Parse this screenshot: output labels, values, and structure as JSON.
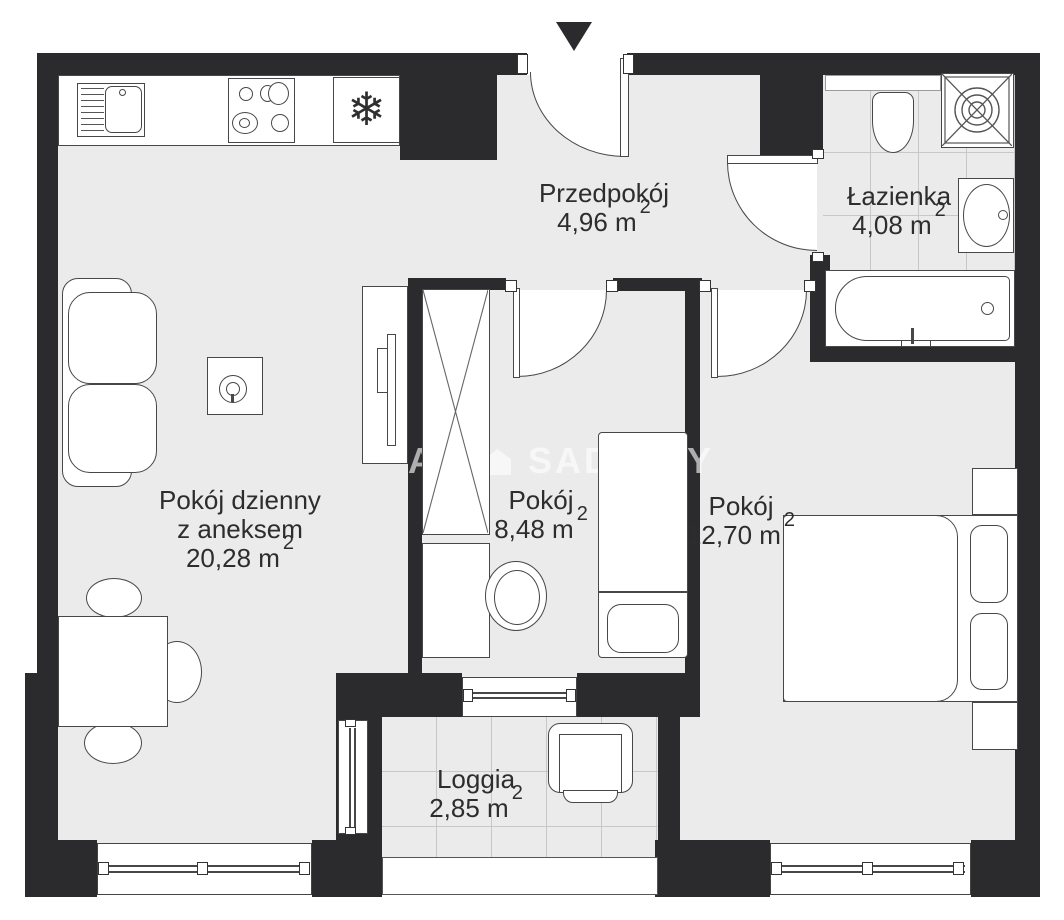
{
  "watermark": {
    "part1": "A",
    "icon": "house-icon",
    "part2": "SADU",
    "part3": "Y"
  },
  "rooms": {
    "hall": {
      "name": "Przedpokój",
      "area": "4,96 m",
      "sup": "2"
    },
    "bath": {
      "name": "Łazienka",
      "area": "4,08 m",
      "sup": "2"
    },
    "living": {
      "name_line1": "Pokój dzienny",
      "name_line2": "z aneksem",
      "area": "20,28 m",
      "sup": "2"
    },
    "room_small": {
      "name": "Pokój",
      "area": "8,48 m",
      "sup": "2"
    },
    "room_large": {
      "name": "Pokój",
      "area": "12,70 m",
      "sup": "2"
    },
    "loggia": {
      "name": "Loggia",
      "area": "2,85 m",
      "sup": "2"
    }
  },
  "icons": {
    "fridge_glyph": "❄"
  },
  "colors": {
    "wall": "#2b2b2d",
    "floor": "#ebebeb",
    "tile_line": "#c7c7c7",
    "outline": "#474747",
    "text": "#2d2d2d"
  }
}
